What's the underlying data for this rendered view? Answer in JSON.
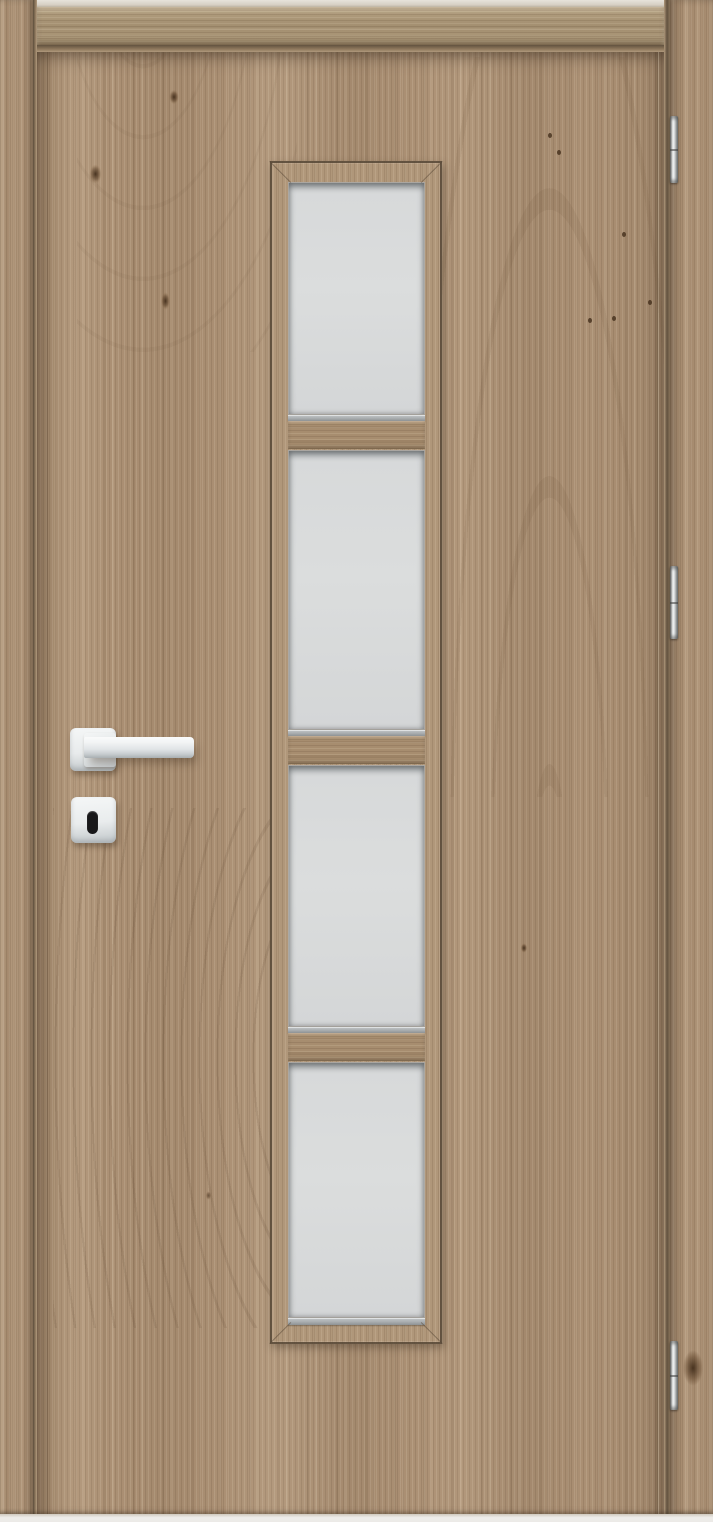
{
  "scene": {
    "type": "product-photo",
    "subject": "wooden interior door with vertical glazing strip",
    "orientation": "front view, full bleed, door hinged on right"
  },
  "door": {
    "finish": "light oak woodgrain laminate, vertical grain on leaf",
    "frame": {
      "head_jamb": "horizontal-grain board across top",
      "left_jamb": "vertical-grain board",
      "right_jamb": "vertical-grain board with dark knot near bottom hinge",
      "reveal_gaps": "dark shadow lines between leaf and frame"
    },
    "glazing": {
      "pane_count": 4,
      "glass_finish": "frosted satin, light gray",
      "layout": "single vertical column, center of leaf",
      "mullion_count": 3,
      "metal_glazing_strip_under_each_pane": true,
      "bead_corners": "mitered"
    },
    "hardware": {
      "lever_handle": {
        "style": "square-rosette straight lever",
        "finish": "matte white",
        "side": "left",
        "points": "right"
      },
      "escutcheon": {
        "style": "square rounded",
        "finish": "matte white"
      },
      "keyhole": {
        "shape": "vertical rounded slot",
        "color": "black"
      },
      "hinges": {
        "count": 3,
        "finish": "chrome",
        "side": "right"
      }
    },
    "grain_features": {
      "cathedral_figure_right_of_glazing": true,
      "fine_arc_swirl_lower_left": true,
      "small_knots_and_specks": 8
    }
  },
  "palette": {
    "wood_base": "#ab9074",
    "jamb_base": "#a38a6b",
    "lintel_base": "#ac9879",
    "bead_base": "#b0977a",
    "rail_base": "#a78d6f",
    "glass": "#d7d9da",
    "sill_metal": "#a9adaf",
    "handle_mid": "#dfe3e5",
    "keyhole": "#18181a",
    "bottom_strip": "#eceae7"
  },
  "titles": {
    "stage": "Light oak interior door with four frosted panes",
    "leaf": "Door leaf",
    "glazing": "Glazed strip with four frosted panes",
    "pane": "Frosted glass pane",
    "handle": "White lever handle",
    "escutcheon": "Keyhole escutcheon",
    "keyhole": "Keyhole",
    "hinge": "Chrome hinge",
    "frame": "Door frame"
  }
}
